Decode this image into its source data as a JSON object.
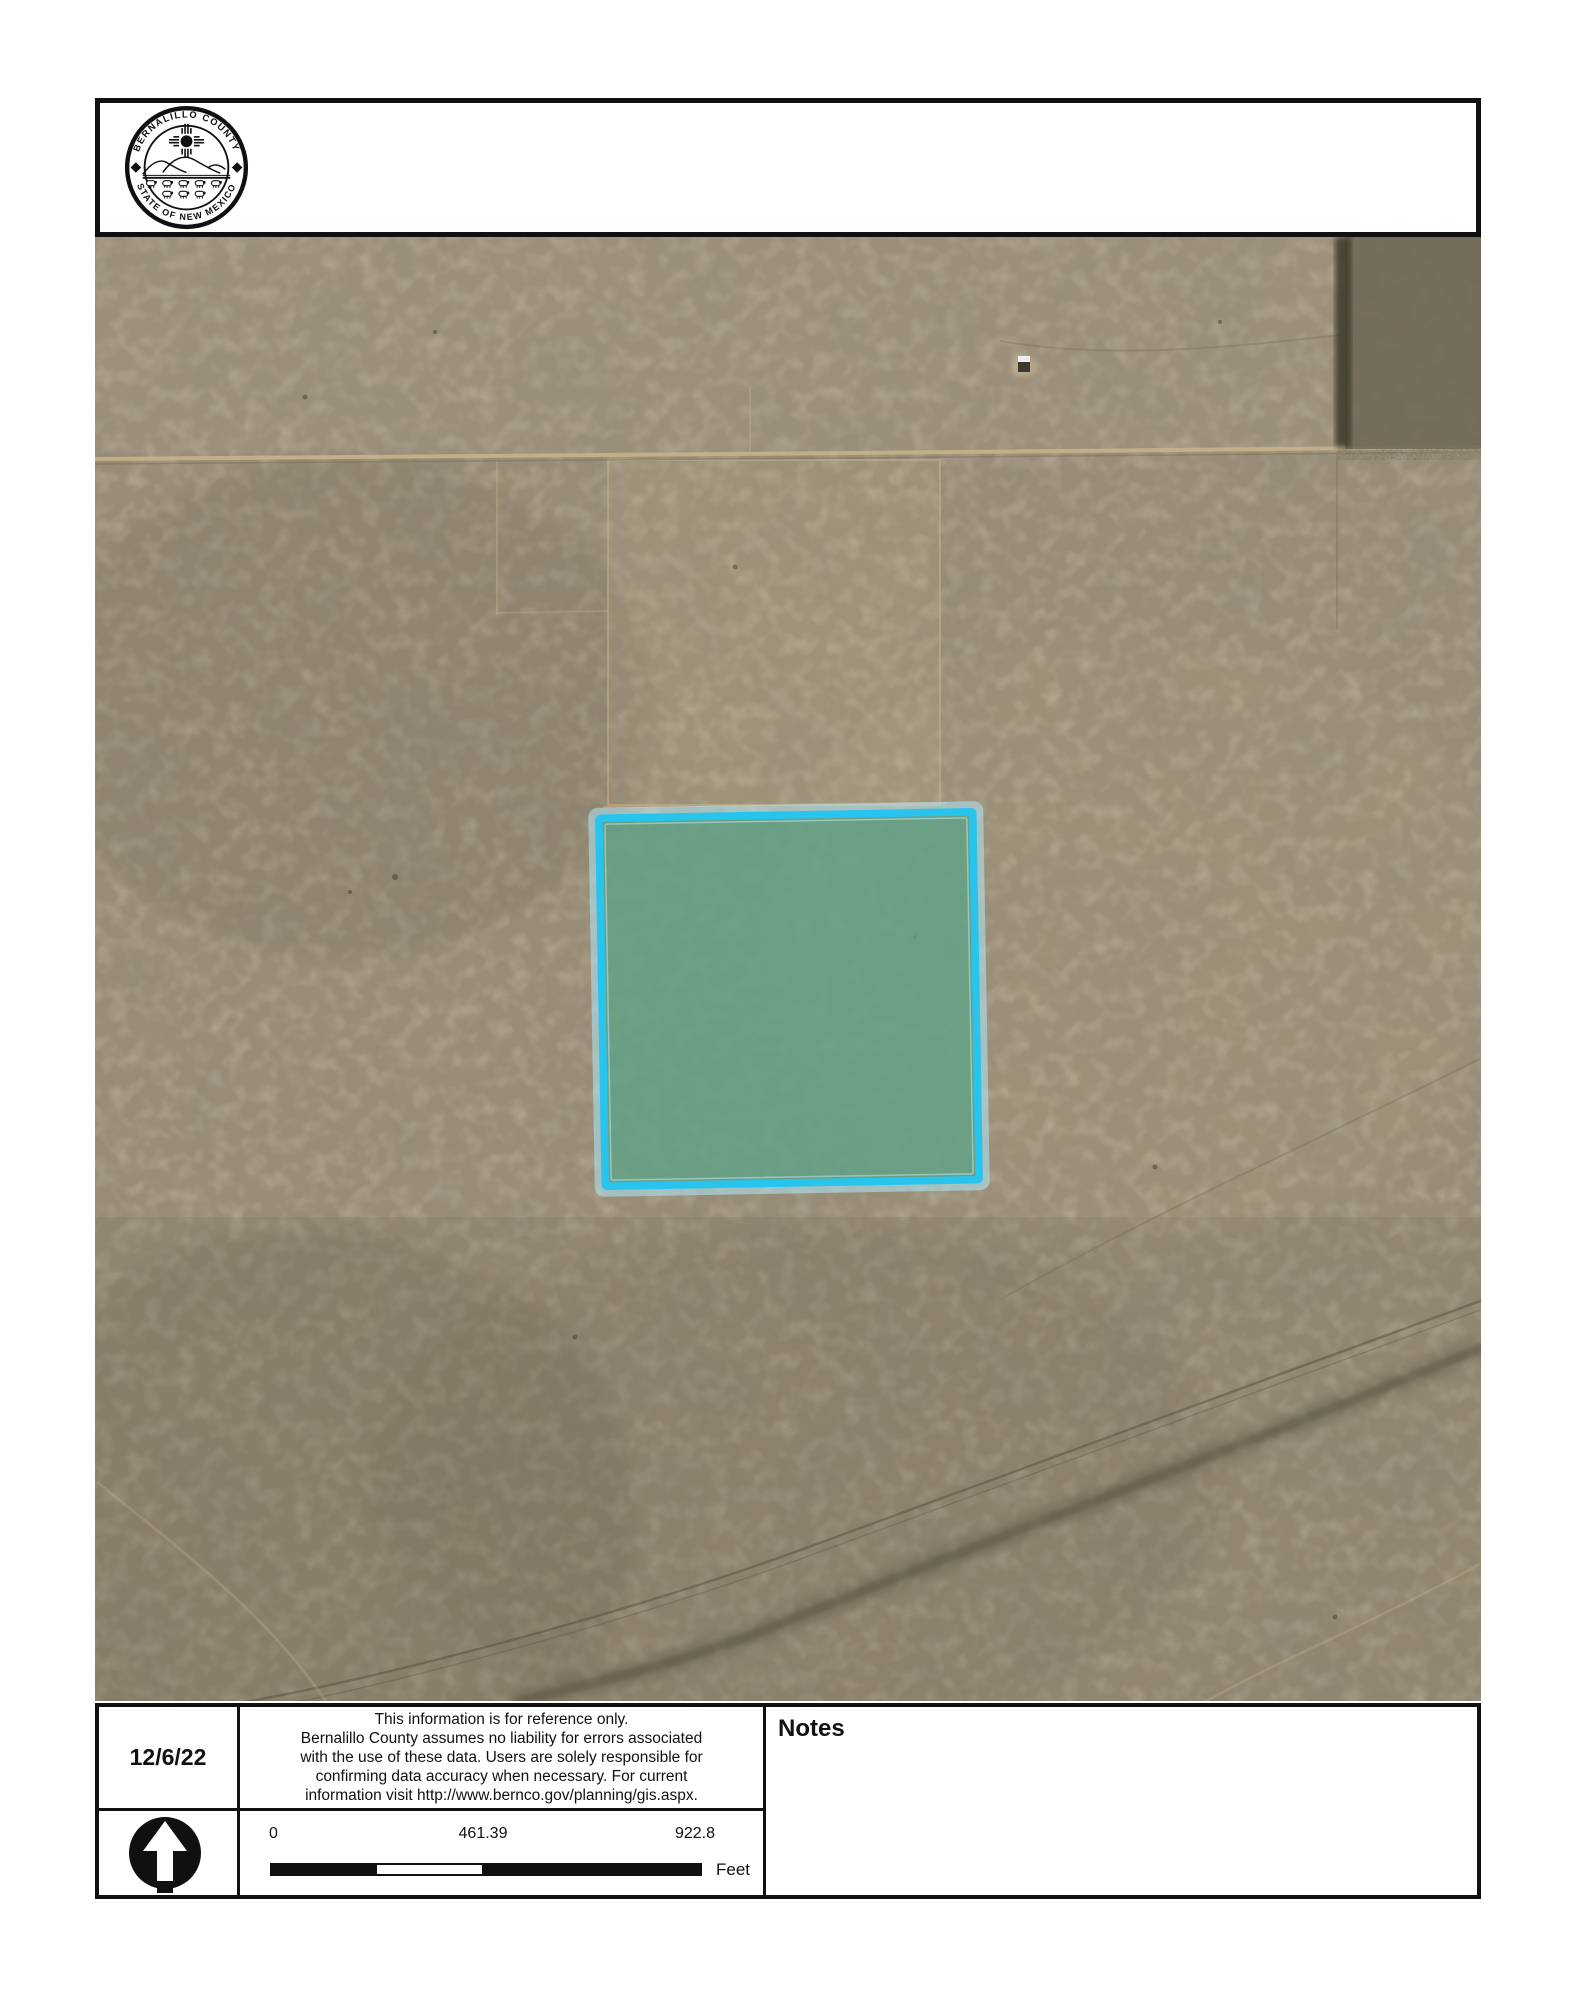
{
  "header": {
    "seal": {
      "arc_top": "BERNALILLO COUNTY",
      "arc_bottom": "STATE OF NEW MEXICO"
    }
  },
  "map": {
    "parcel": {
      "border_color": "#27c4ee",
      "fill_color": "#5fa287"
    },
    "terrain_base_color": "#998d76"
  },
  "footer": {
    "date": "12/6/22",
    "disclaimer_lines": [
      "This information is for reference only.",
      "Bernalillo County assumes no liability for errors associated",
      "with the use of these data. Users are solely responsible for",
      "confirming data accuracy when necessary. For current",
      "information visit http://www.bernco.gov/planning/gis.aspx."
    ],
    "notes_label": "Notes",
    "scale_bar": {
      "start_label": "0",
      "mid_label": "461.39",
      "end_label": "922.8",
      "unit_label": "Feet"
    }
  }
}
